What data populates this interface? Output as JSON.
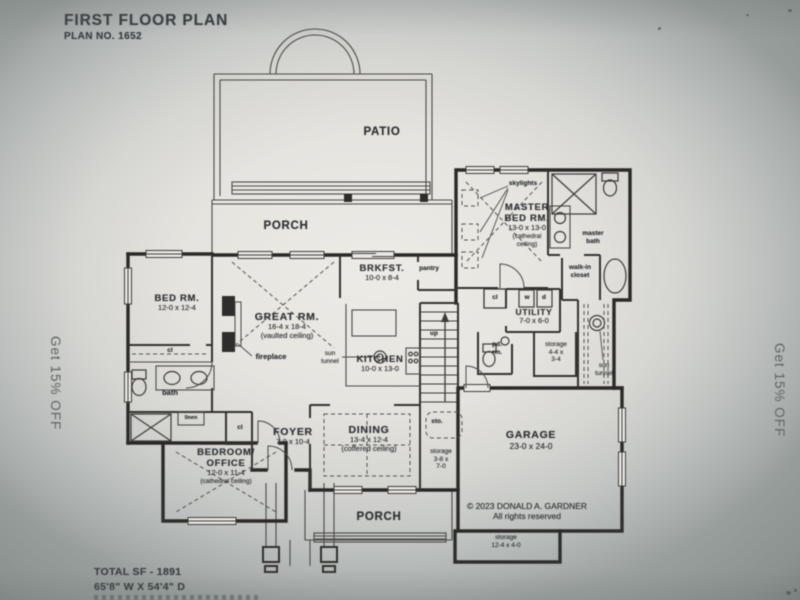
{
  "photo": {
    "header": {
      "title": "FIRST FLOOR PLAN",
      "plan_no": "PLAN NO. 1652"
    },
    "footer": {
      "total_sf": "TOTAL SF - 1891",
      "dimensions": "65'8\" W X 54'4\" D"
    },
    "promo_left": "Get 15% OFF",
    "promo_right": "Get 15% OFF",
    "copyright": {
      "line1": "© 2023  DONALD A. GARDNER",
      "line2": "All rights reserved"
    }
  },
  "rooms": {
    "patio": {
      "name": "PATIO"
    },
    "porch_top": {
      "name": "PORCH"
    },
    "porch_bottom": {
      "name": "PORCH"
    },
    "master_bed": {
      "name1": "MASTER",
      "name2": "BED RM.",
      "dims": "13-0 x 13-0",
      "note1": "(cathedral",
      "note2": "ceiling)"
    },
    "master_bath": {
      "name1": "master",
      "name2": "bath"
    },
    "walk_in_closet": {
      "name1": "walk-in",
      "name2": "closet"
    },
    "bed_rm": {
      "name": "BED RM.",
      "dims": "12-0 x 12-4"
    },
    "great_rm": {
      "name": "GREAT RM.",
      "dims": "16-4 x 18-4",
      "note": "(vaulted ceiling)"
    },
    "brkfst": {
      "name": "BRKFST.",
      "dims": "10-0 x 8-4"
    },
    "kitchen": {
      "name": "KITCHEN",
      "dims": "10-0 x 13-0"
    },
    "utility": {
      "name": "UTILITY",
      "dims": "7-0 x 6-0"
    },
    "pd_rm": {
      "line1": "pd.",
      "line2": "rm."
    },
    "storage_hall": {
      "name": "storage",
      "dims1": "4-4 x",
      "dims2": "3-4"
    },
    "storage_stairs": {
      "name": "storage",
      "dims1": "3-8 x",
      "dims2": "7-0"
    },
    "storage_garage": {
      "name": "storage",
      "dims": "12-4 x 4-0"
    },
    "foyer": {
      "name": "FOYER",
      "dims": "7-0 x 10-4"
    },
    "dining": {
      "name": "DINING",
      "dims": "13-4 x 12-4",
      "note": "(coffered ceiling)"
    },
    "bedroom_office": {
      "name1": "BEDROOM/",
      "name2": "OFFICE",
      "dims": "12-0 x 11-4",
      "note": "(cathedral ceiling)"
    },
    "garage": {
      "name": "GARAGE",
      "dims": "23-0 x 24-0"
    },
    "bath": {
      "name": "bath"
    }
  },
  "annotations": {
    "skylights": "skylights",
    "fireplace": "fireplace",
    "sun_tunnel_a": {
      "line1": "sun",
      "line2": "tunnel"
    },
    "sun_tunnel_b": {
      "line1": "sun",
      "line2": "tunnel"
    },
    "pantry": "pantry",
    "up": "up",
    "sto": "sto.",
    "linen": "linen",
    "washer": "w",
    "dryer": "d",
    "cl_bedroom": "cl",
    "cl_foyer": "cl",
    "cl_hall": "cl"
  }
}
